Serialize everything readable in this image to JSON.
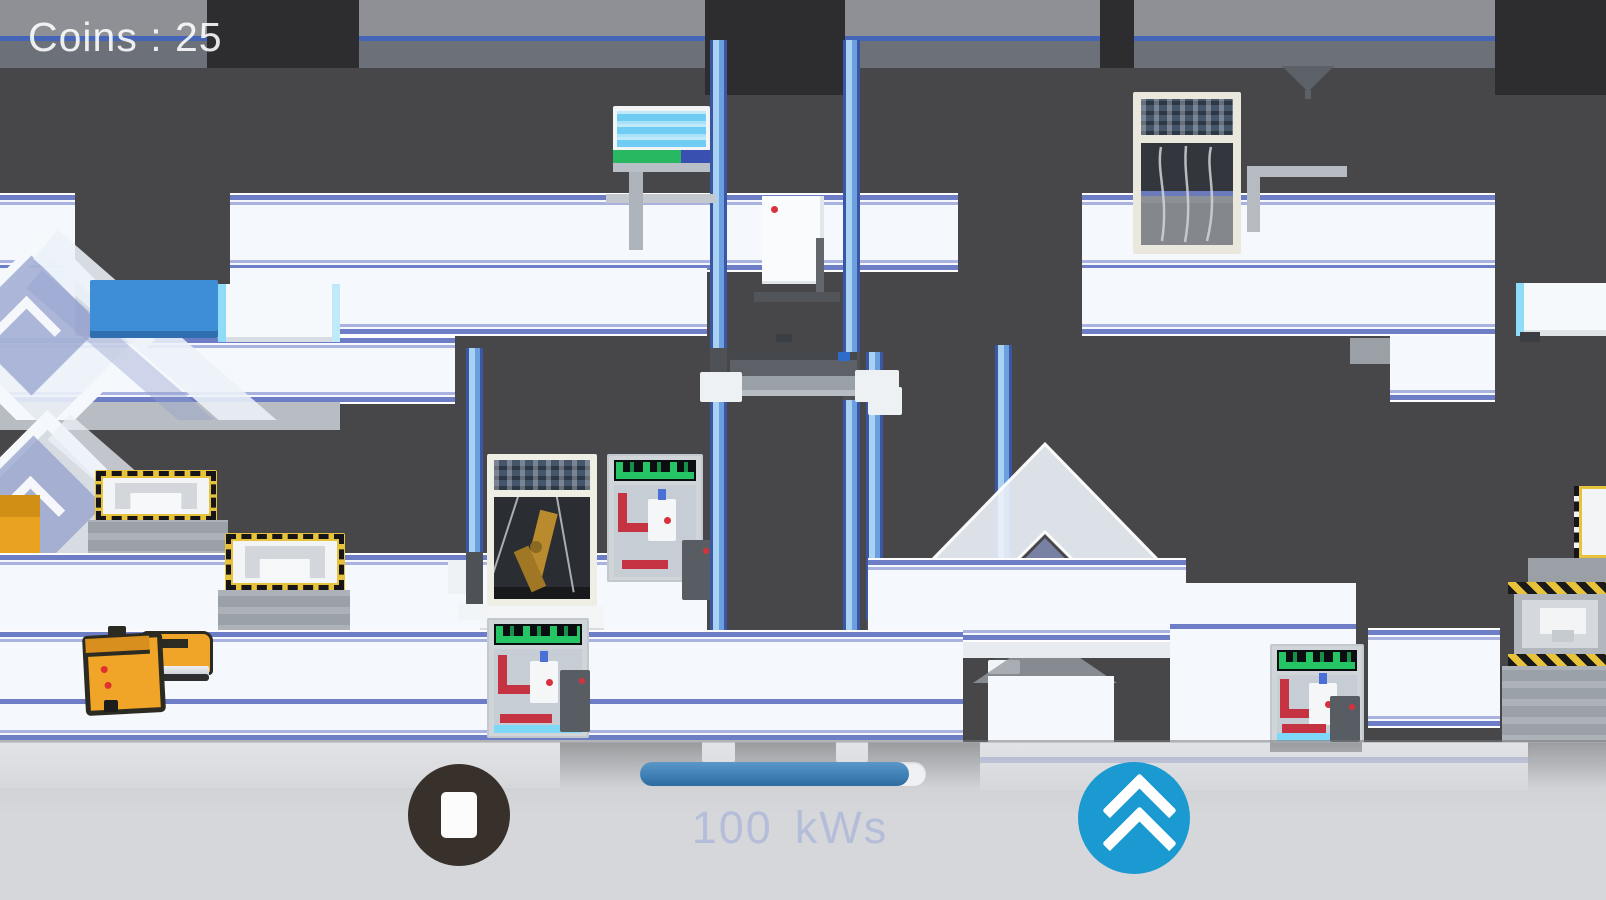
{
  "hud": {
    "coins_text": "Coins : 25"
  },
  "power_meter": {
    "value": "100",
    "unit": "kWs",
    "display": "100 kWs",
    "progress_percent": 94
  },
  "controls": {
    "stop_button_icon": "stop-square-icon",
    "boost_button_icon": "double-chevron-up-icon"
  },
  "colors": {
    "background_dark": "#47474a",
    "top_band": "#2d2d30",
    "platform_white": "#f5f8fd",
    "stripe_blue": "#6e7ec6",
    "pillar_light": "#a9d1f1",
    "pillar_mid": "#6b9fe0",
    "pillar_dark": "#3a57a5",
    "hud_text": "#ffffff",
    "power_text": "#b4bed9",
    "progress_fill": "#3f80b6",
    "boost_button": "#1b9ad1",
    "stop_button": "#38302b",
    "hazard_yellow": "#e6c33a",
    "robot_yellow": "#f0a528",
    "accent_red": "#d8303c",
    "accent_green": "#25c465",
    "glass_blue": "#929ecc",
    "crate_blue": "#3d8ed6",
    "cyan_edge": "#8fdcf8"
  },
  "scene": {
    "objects": [
      "conveyor-platforms",
      "support-pillars",
      "display-screen-machine",
      "paper-box",
      "solar-panel-machine",
      "robot-arm-cabinet",
      "assembly-machine",
      "press-machine",
      "hazard-press-machine",
      "glass-diamond-decoration",
      "glass-arrow-decoration",
      "worker-robot",
      "forklift-vehicle",
      "elevator-platform",
      "blue-crate"
    ]
  }
}
